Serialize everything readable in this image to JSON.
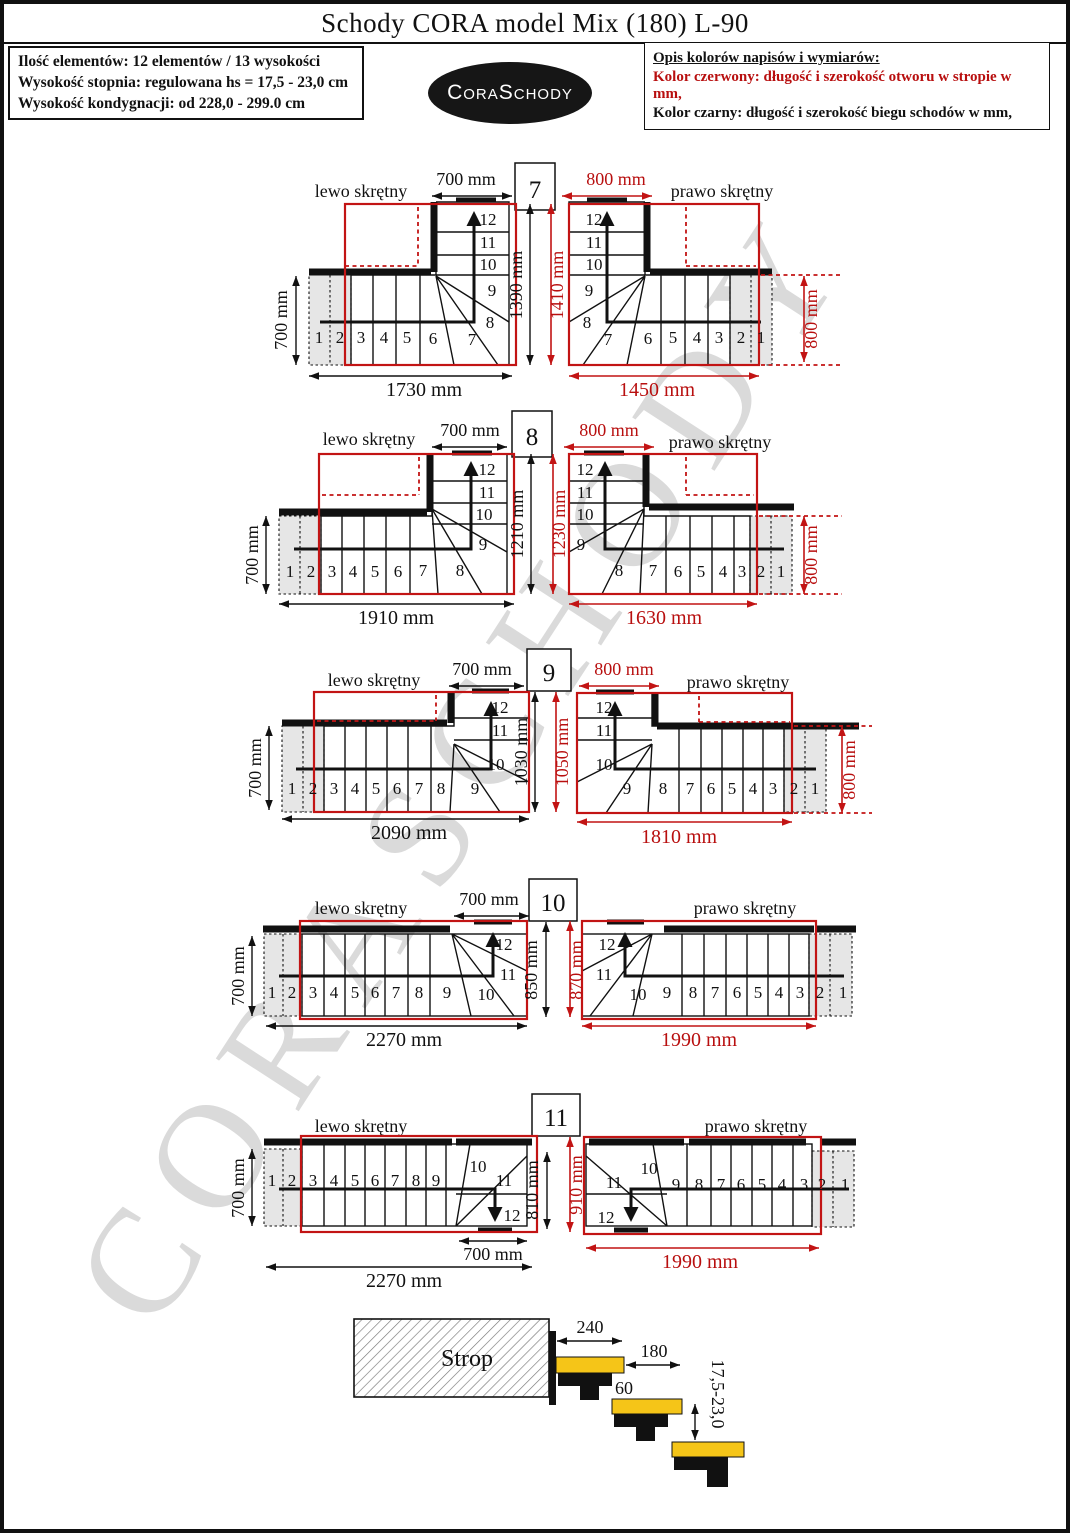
{
  "page": {
    "title": "Schody CORA model Mix (180) L-90"
  },
  "info_box": {
    "line1": "Ilość elementów: 12 elementów / 13 wysokości",
    "line2": "Wysokość stopnia: regulowana  hs = 17,5 - 23,0 cm",
    "line3": "Wysokość kondygnacji: od 228,0 - 299.0 cm"
  },
  "logo": {
    "text": "CoraSchody"
  },
  "legend_box": {
    "title": "Opis kolorów napisów i wymiarów:",
    "red_line": "Kolor czerwony:  długość i szerokość otworu w stropie w mm,",
    "black_line": "Kolor czarny:  długość i szerokość biegu schodów w mm,"
  },
  "watermark": "CORASCHODY",
  "colors": {
    "dim_red": "#b80f0f",
    "line_black": "#111111",
    "strip_grey": "#e6e6e6",
    "tread_yellow": "#f5c518",
    "watermark_grey": "#dadada"
  },
  "rows": [
    {
      "num": "7",
      "left": {
        "label": "lewo skrętny",
        "steps": [
          "1",
          "2",
          "3",
          "4",
          "5",
          "6",
          "7",
          "8",
          "9",
          "10",
          "11",
          "12"
        ],
        "dims": {
          "top": "700 mm",
          "side": "700 mm",
          "bottom": "1730 mm",
          "height": "1390 mm"
        }
      },
      "right": {
        "label": "prawo skrętny",
        "steps": [
          "1",
          "2",
          "3",
          "4",
          "5",
          "6",
          "7",
          "8",
          "9",
          "10",
          "11",
          "12"
        ],
        "dims": {
          "top": "800 mm",
          "bottom": "1450 mm",
          "side": "800 mm",
          "opening_height": "1410 mm"
        }
      }
    },
    {
      "num": "8",
      "left": {
        "label": "lewo skrętny",
        "steps": [
          "1",
          "2",
          "3",
          "4",
          "5",
          "6",
          "7",
          "8",
          "9",
          "10",
          "11",
          "12"
        ],
        "dims": {
          "top": "700 mm",
          "side": "700 mm",
          "bottom": "1910 mm",
          "height": "1210 mm"
        }
      },
      "right": {
        "label": "prawo skrętny",
        "steps": [
          "1",
          "2",
          "3",
          "4",
          "5",
          "6",
          "7",
          "8",
          "9",
          "10",
          "11",
          "12"
        ],
        "dims": {
          "top": "800 mm",
          "bottom": "1630 mm",
          "side": "800 mm",
          "opening_height": "1230 mm"
        }
      }
    },
    {
      "num": "9",
      "left": {
        "label": "lewo skrętny",
        "steps": [
          "1",
          "2",
          "3",
          "4",
          "5",
          "6",
          "7",
          "8",
          "9",
          "10",
          "11",
          "12"
        ],
        "dims": {
          "top": "700 mm",
          "side": "700 mm",
          "bottom": "2090 mm",
          "height": "1030 mm"
        }
      },
      "right": {
        "label": "prawo skrętny",
        "steps": [
          "1",
          "2",
          "3",
          "4",
          "5",
          "6",
          "7",
          "8",
          "9",
          "10",
          "11",
          "12"
        ],
        "dims": {
          "top": "800 mm",
          "bottom": "1810 mm",
          "side": "800 mm",
          "opening_height": "1050 mm"
        }
      }
    },
    {
      "num": "10",
      "left": {
        "label": "lewo skrętny",
        "steps": [
          "1",
          "2",
          "3",
          "4",
          "5",
          "6",
          "7",
          "8",
          "9",
          "10",
          "11",
          "12"
        ],
        "dims": {
          "top": "700 mm",
          "side": "700 mm",
          "bottom": "2270 mm",
          "height": "850 mm"
        }
      },
      "right": {
        "label": "prawo skrętny",
        "steps": [
          "1",
          "2",
          "3",
          "4",
          "5",
          "6",
          "7",
          "8",
          "9",
          "10",
          "11",
          "12"
        ],
        "dims": {
          "bottom": "1990 mm",
          "opening_height": "870 mm"
        }
      }
    },
    {
      "num": "11",
      "left": {
        "label": "lewo skrętny",
        "steps": [
          "1",
          "2",
          "3",
          "4",
          "5",
          "6",
          "7",
          "8",
          "9",
          "10",
          "11",
          "12"
        ],
        "dims": {
          "side": "700 mm",
          "exit": "700 mm",
          "bottom": "2270 mm",
          "height": "810 mm"
        }
      },
      "right": {
        "label": "prawo skrętny",
        "steps": [
          "1",
          "2",
          "3",
          "4",
          "5",
          "6",
          "7",
          "8",
          "9",
          "10",
          "11",
          "12"
        ],
        "dims": {
          "bottom": "1990 mm",
          "opening_height": "910 mm"
        }
      }
    }
  ],
  "side_view": {
    "label": "Strop",
    "dims": {
      "tread_top": "240",
      "tread": "180",
      "overlap": "60",
      "rise": "17,5-23,0"
    }
  }
}
